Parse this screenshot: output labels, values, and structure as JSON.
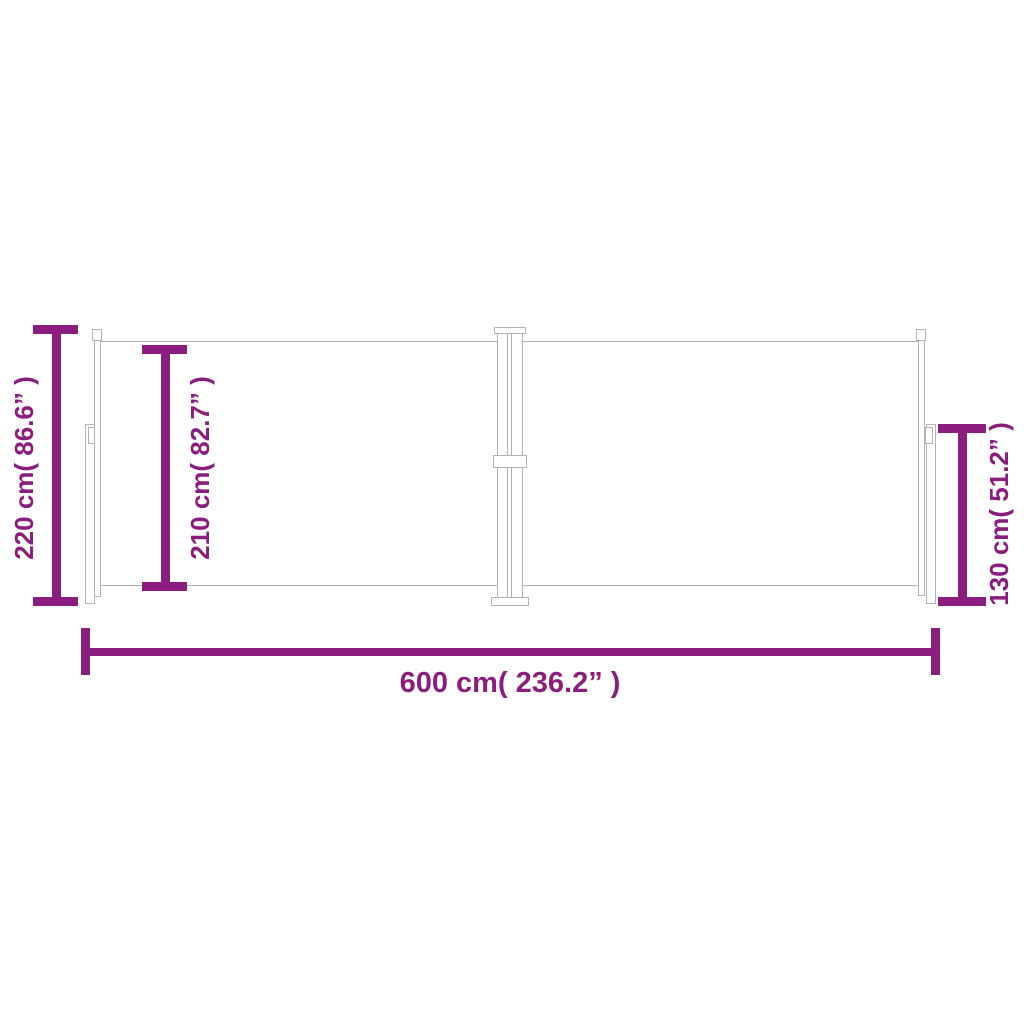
{
  "colors": {
    "dimension": "#8b1d7f",
    "outline": "#b3b3b3",
    "background": "#ffffff"
  },
  "diagram": {
    "kind": "product-dimension-drawing",
    "dimensions": {
      "total_height": {
        "label": "220 cm( 86.6” )",
        "cm": 220,
        "inches": 86.6
      },
      "fabric_height": {
        "label": "210 cm( 82.7” )",
        "cm": 210,
        "inches": 82.7
      },
      "cassette_height": {
        "label": "130 cm( 51.2” )",
        "cm": 130,
        "inches": 51.2
      },
      "total_width": {
        "label": "600 cm( 236.2” )",
        "cm": 600,
        "inches": 236.2
      }
    }
  }
}
